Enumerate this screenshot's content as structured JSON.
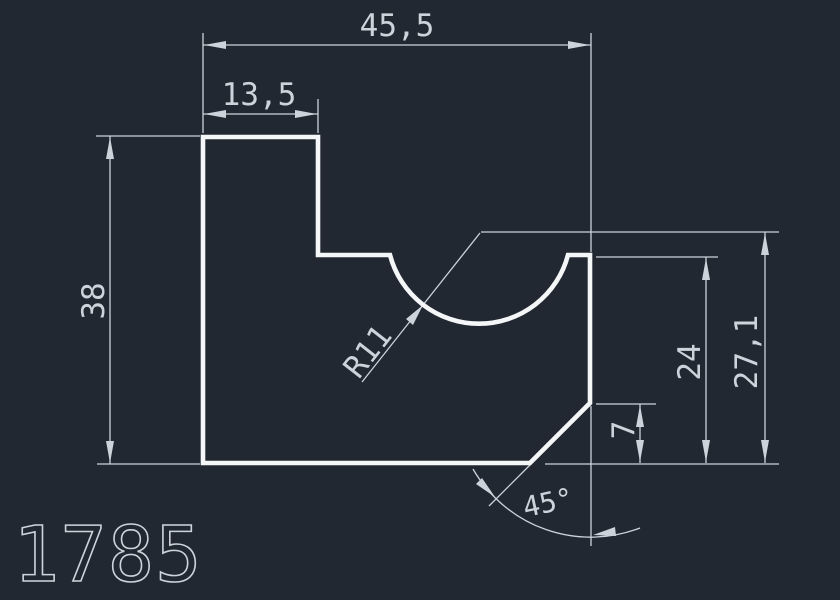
{
  "drawing": {
    "part_number": "1785",
    "dimensions": {
      "total_width": "45,5",
      "step_width": "13,5",
      "total_height": "38",
      "notch_radius": "R11",
      "shoulder_height": "24",
      "center_height": "27,1",
      "chamfer_height": "7",
      "chamfer_angle": "45°"
    },
    "colors": {
      "background": "#212831",
      "part_outline": "#f4f6f8",
      "dimension_lines": "#cdd3db"
    }
  }
}
